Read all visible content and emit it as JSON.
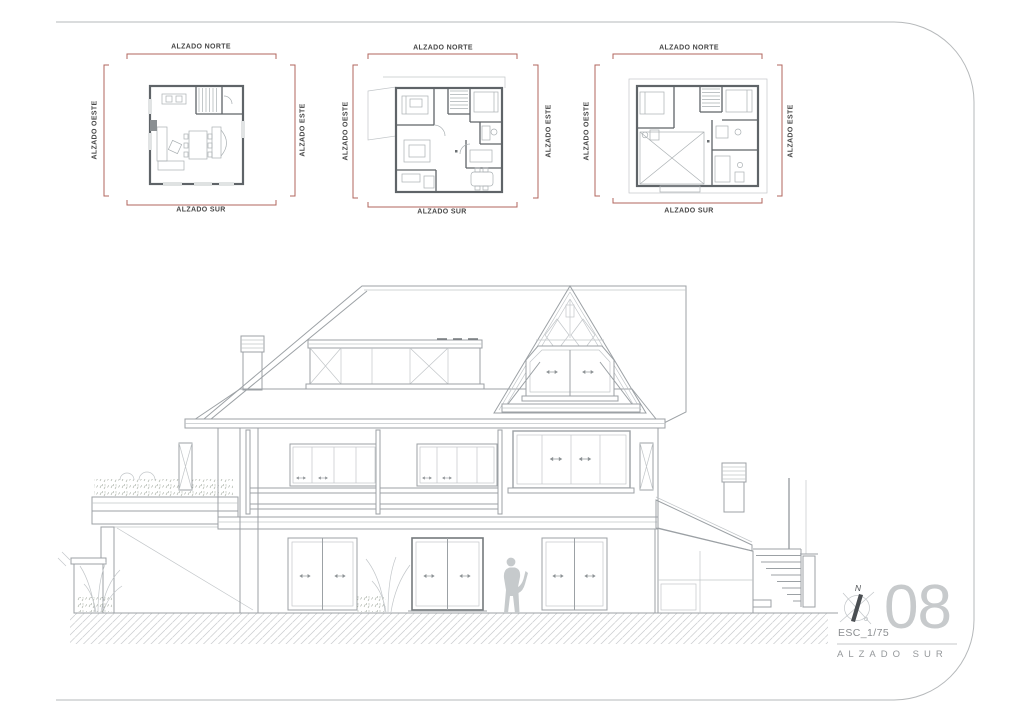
{
  "plans": [
    {
      "labels": {
        "north": "ALZADO NORTE",
        "south": "ALZADO SUR",
        "west": "ALZADO OESTE",
        "east": "ALZADO ESTE"
      }
    },
    {
      "labels": {
        "north": "ALZADO NORTE",
        "south": "ALZADO SUR",
        "west": "ALZADO OESTE",
        "east": "ALZADO ESTE"
      }
    },
    {
      "labels": {
        "north": "ALZADO NORTE",
        "south": "ALZADO SUR",
        "west": "ALZADO OESTE",
        "east": "ALZADO ESTE"
      }
    }
  ],
  "titleblock": {
    "scale_label": "ESC_1/75",
    "sheet_number": "08",
    "drawing_title": "ALZADO SUR",
    "compass_north_letter": "N"
  },
  "colors": {
    "dimension_red": "#b2655c",
    "drawing_line_gray": "#9ca1a5",
    "light_line_gray": "#c2c6c9",
    "figure_gray": "#c6cacc",
    "sheet_number_gray": "#c7cacc",
    "page_border_gray": "#b6b9bb"
  }
}
